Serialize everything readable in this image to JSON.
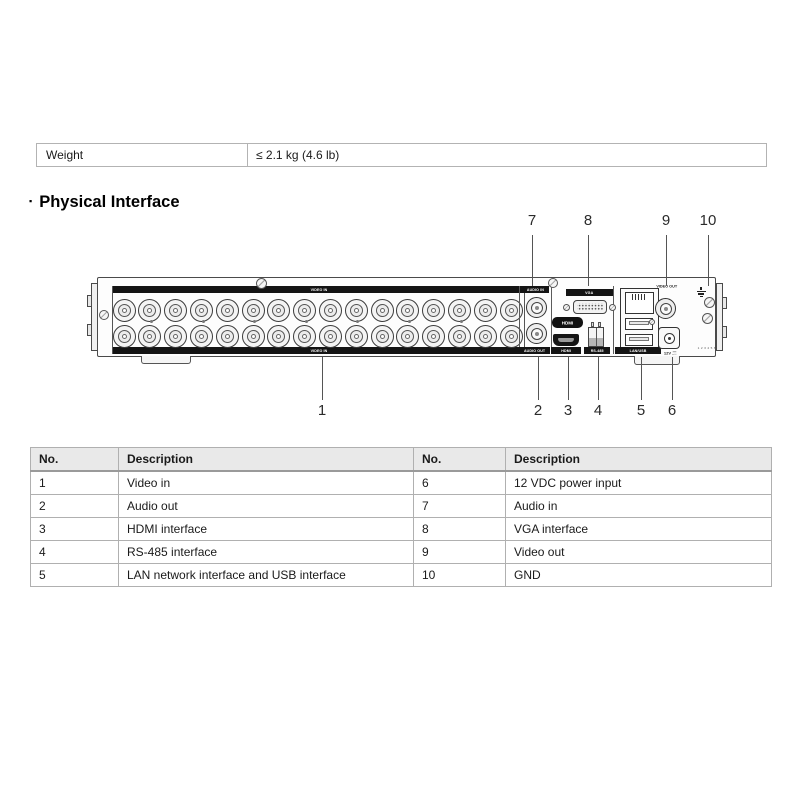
{
  "spec_row": {
    "label": "Weight",
    "value": "≤ 2.1 kg (4.6 lb)"
  },
  "section": {
    "bullet": "▪",
    "title": "Physical Interface"
  },
  "diagram": {
    "labels": {
      "video_in_top": "VIDEO IN",
      "video_in_bottom": "VIDEO IN",
      "audio_in": "AUDIO IN",
      "audio_out": "AUDIO OUT",
      "vga": "VGA",
      "hdmi_logo": "HDMI",
      "hdmi": "HDMI",
      "rs485": "RS-485",
      "lan_usb": "LAN/USB",
      "video_out": "VIDEO OUT",
      "power": "12V",
      "serial_marks": "1 2 3 4 5 6"
    },
    "callouts_top": [
      "7",
      "8",
      "9",
      "10"
    ],
    "callouts_bottom": [
      "1",
      "2",
      "3",
      "4",
      "5",
      "6"
    ],
    "bnc_grid": {
      "rows": 2,
      "cols": 16
    }
  },
  "port_table": {
    "headers": [
      "No.",
      "Description",
      "No.",
      "Description"
    ],
    "rows": [
      [
        "1",
        "Video in",
        "6",
        "12 VDC power input"
      ],
      [
        "2",
        "Audio out",
        "7",
        "Audio in"
      ],
      [
        "3",
        "HDMI interface",
        "8",
        "VGA interface"
      ],
      [
        "4",
        "RS-485 interface",
        "9",
        "Video out"
      ],
      [
        "5",
        "LAN network interface and USB interface",
        "10",
        "GND"
      ]
    ]
  },
  "colors": {
    "table_border": "#b3b3b3",
    "header_bg": "#e9e9e9",
    "strip_bg": "#141414",
    "diagram_line": "#4a4a4a"
  }
}
